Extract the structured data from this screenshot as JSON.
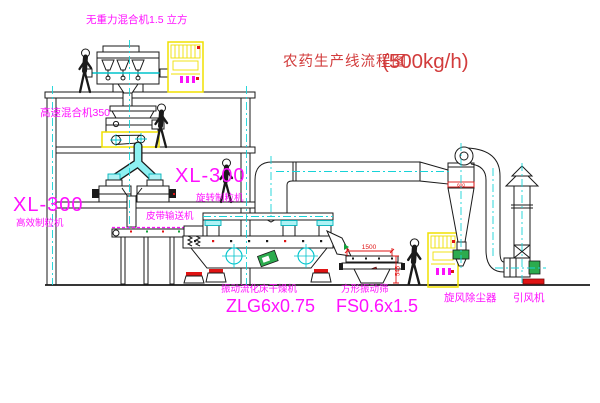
{
  "title": {
    "text": "农药生产线流程图",
    "capacity": "(500kg/h)"
  },
  "labels": {
    "top_mixer": "无重力混合机1.5 立方",
    "high_speed_mixer": "高速混合机350",
    "left_granulator_model": "XL-300",
    "left_granulator_name": "高效制粒机",
    "right_granulator_model": "XL-300",
    "right_granulator_name": "旋转制粒机",
    "belt_conveyor": "皮带输送机",
    "dryer_name": "振动流化床干燥机",
    "dryer_model": "ZLG6x0.75",
    "sieve_name": "方形振动筛",
    "sieve_model": "FS0.6x1.5",
    "cyclone": "旋风除尘器",
    "fan": "引风机"
  },
  "dimensions": {
    "sieve_length": "1500",
    "sieve_height": "545",
    "cyclone_marking": "600"
  },
  "colors": {
    "label_magenta": "#ff10ff",
    "title_red": "#d23c3c",
    "dimension_red": "#e01414",
    "line_black": "#1a1a1a",
    "centerline_cyan": "#17d3d8",
    "cabinet_yellow": "#f0e000",
    "machine_green": "#2cab4e"
  }
}
